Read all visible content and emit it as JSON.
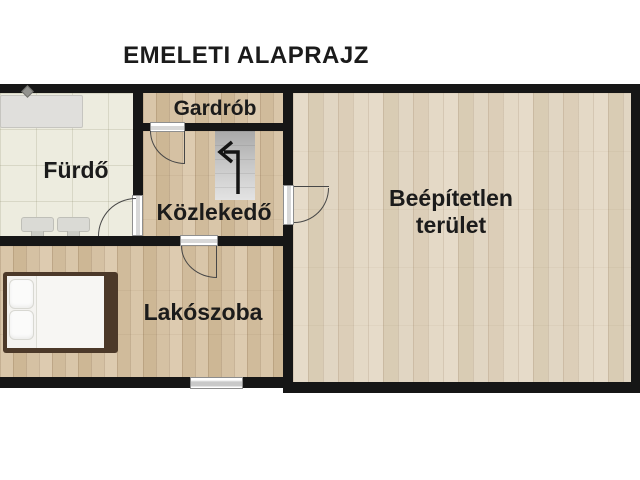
{
  "title": "EMELETI ALAPRAJZ",
  "rooms": {
    "furdo": {
      "label": "Fürdő"
    },
    "gardrob": {
      "label": "Gardrób"
    },
    "kozlekedo": {
      "label": "Közlekedő"
    },
    "lakoszoba": {
      "label": "Lakószoba"
    },
    "beepitetlen": {
      "label": "Beépítetlen terület",
      "label_line1": "Beépítetlen",
      "label_line2": "terület"
    }
  },
  "fixtures": {
    "stairs": "staircase-with-up-arrow",
    "bathtub": "bathtub",
    "shower": "shower-head",
    "sinks": "twin-sinks",
    "bed": "double-bed",
    "window": "window",
    "doors": "door-swing-symbols"
  },
  "colors": {
    "wall": "#161616",
    "wood_floor_left": "#d3bfa0",
    "wood_floor_right": "#ddd1bd",
    "tile_floor": "#edecdf",
    "stairs_gray": "#c6c6c6",
    "bed_frame": "#4c3929",
    "text": "#1b1b1b",
    "background": "#ffffff"
  }
}
